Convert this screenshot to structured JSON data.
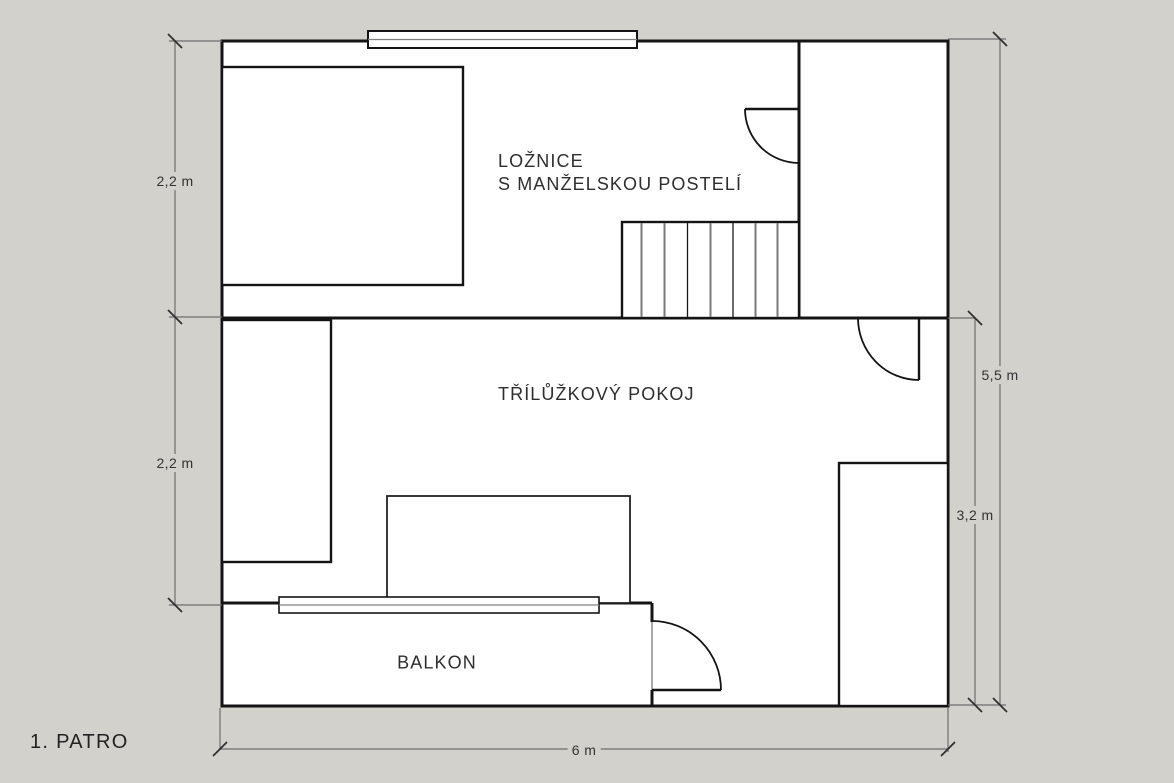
{
  "floor_label": "1. PATRO",
  "rooms": {
    "bedroom": {
      "name_line1": "LOŽNICE",
      "name_line2": "S MANŽELSKOU POSTELÍ"
    },
    "triple_room": {
      "name": "TŘÍLŮŽKOVÝ POKOJ"
    },
    "balcony": {
      "name": "BALKON"
    }
  },
  "dimensions": {
    "left_upper": "2,2 m",
    "left_lower": "2,2 m",
    "right_total": "5,5 m",
    "right_lower": "3,2 m",
    "bottom_total": "6 m"
  },
  "colors": {
    "background": "#d2d1cb",
    "floor_fill": "#ffffff",
    "wall": "#141414",
    "dimension_line": "#6e6e6e",
    "dimension_tick": "#2f2f2f",
    "text": "#2e2e2e"
  }
}
